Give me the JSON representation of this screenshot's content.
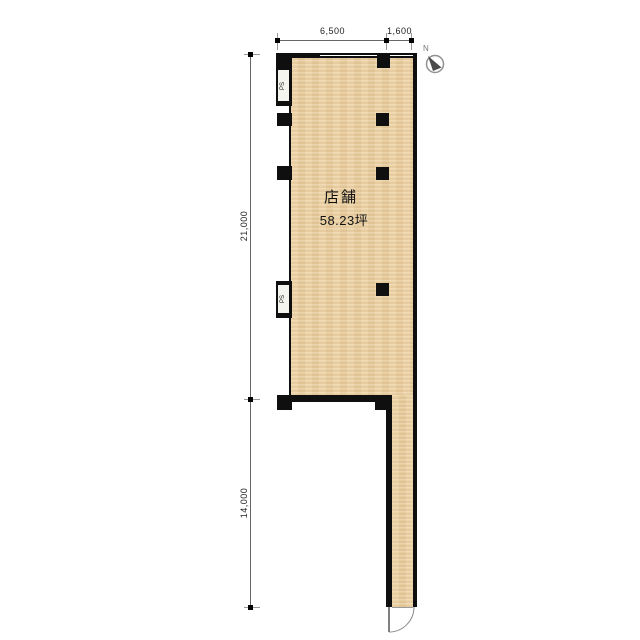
{
  "room": {
    "name": "店舗",
    "area": "58.23坪"
  },
  "ps1": {
    "label": "PS"
  },
  "ps2": {
    "label": "PS"
  },
  "dimensions": {
    "top_width_main": "6,500",
    "top_width_entry": "1,600",
    "left_height_main": "21,000",
    "left_height_lower": "14,000"
  },
  "compass": {
    "label": "N"
  },
  "colors": {
    "wall": "#0f0f0f",
    "floor": "#ecd2a4",
    "dimension_line": "#666666"
  }
}
